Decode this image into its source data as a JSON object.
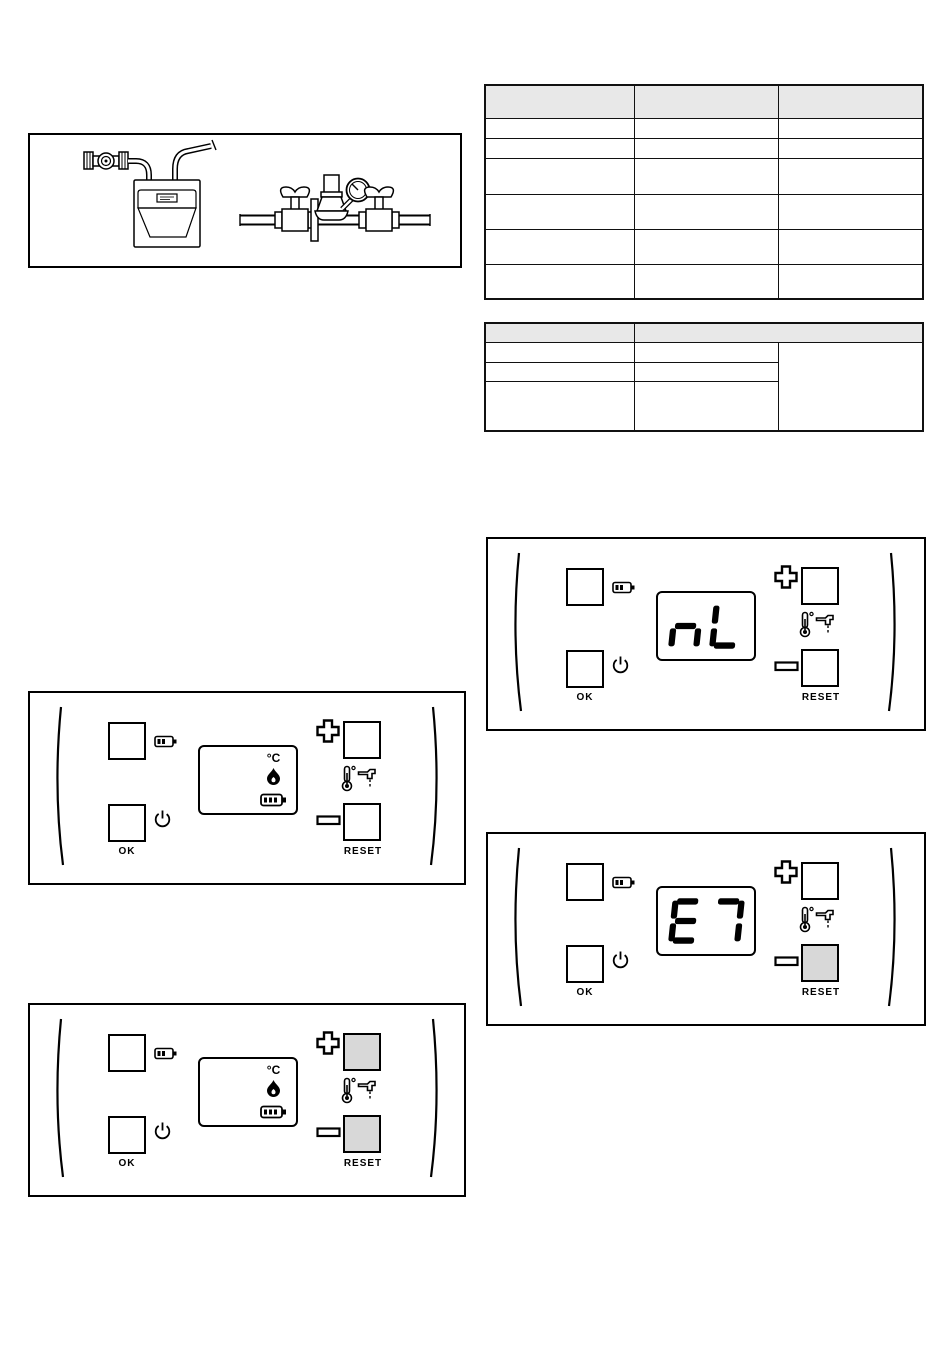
{
  "colors": {
    "line": "#000000",
    "button_highlight_fill": "#d8d8d8",
    "table_header_fill": "#e8e8e8"
  },
  "tables": {
    "spec_table": {
      "columns": [
        "",
        "",
        ""
      ],
      "rows": [
        [
          "",
          "",
          ""
        ],
        [
          "",
          "",
          ""
        ],
        [
          "",
          "",
          ""
        ],
        [
          "",
          "",
          ""
        ],
        [
          "",
          "",
          ""
        ],
        [
          "",
          "",
          ""
        ]
      ]
    },
    "small_table": {
      "columns": [
        "",
        ""
      ],
      "rows": [
        [
          "",
          ""
        ],
        [
          "",
          ""
        ],
        [
          "",
          ""
        ]
      ],
      "merged_cell": ""
    }
  },
  "panel_labels": {
    "ok": "OK",
    "reset": "RESET"
  },
  "panels": [
    {
      "display_mode": "icons",
      "temp_unit": "°C",
      "highlighted_buttons": []
    },
    {
      "display_mode": "icons",
      "temp_unit": "°C",
      "highlighted_buttons": [
        "plus",
        "minus"
      ]
    },
    {
      "display_mode": "code",
      "code": "nL",
      "highlighted_buttons": []
    },
    {
      "display_mode": "code",
      "code": "E7",
      "highlighted_buttons": [
        "minus"
      ]
    }
  ]
}
